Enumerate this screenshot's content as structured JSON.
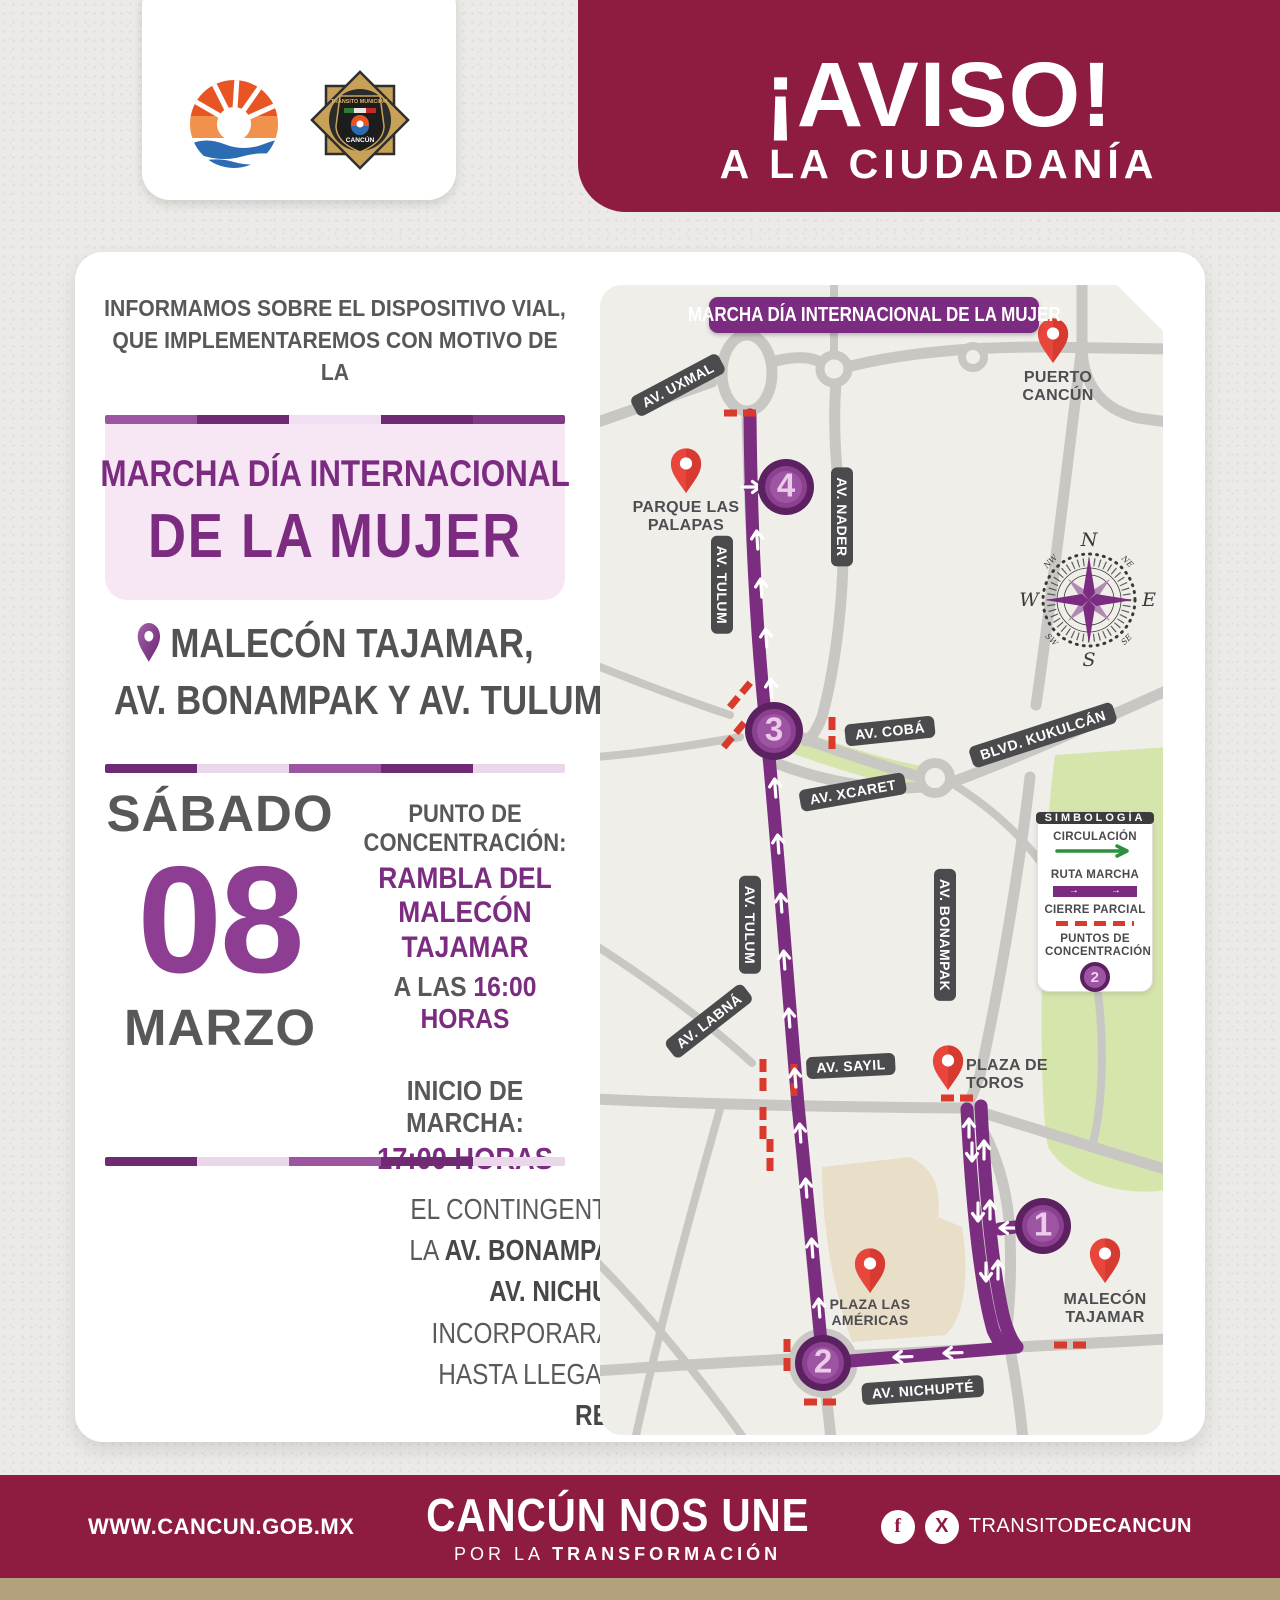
{
  "header": {
    "aviso_title": "¡AVISO!",
    "aviso_subtitle": "A LA CIUDADANÍA",
    "badge_line1": "TRÁNSITO MUNICIPAL",
    "badge_line2": "CANCÚN"
  },
  "intro": {
    "text": "INFORMAMOS SOBRE EL DISPOSITIVO VIAL, QUE IMPLEMENTAREMOS CON MOTIVO DE LA"
  },
  "event": {
    "title_line1": "MARCHA DÍA INTERNACIONAL",
    "title_line2": "DE LA MUJER"
  },
  "location": {
    "line1": "MALECÓN TAJAMAR,",
    "line2": "AV. BONAMPAK Y AV. TULUM"
  },
  "schedule": {
    "day": "SÁBADO",
    "date": "08",
    "month": "MARZO",
    "concentration_label": "PUNTO DE CONCENTRACIÓN:",
    "concentration_place": "RAMBLA DEL MALECÓN TAJAMAR",
    "concentration_time_prefix": "A LAS",
    "concentration_time": "16:00 HORAS",
    "march_label": "INICIO DE MARCHA:",
    "march_time": "17:00 HORAS"
  },
  "description": {
    "segments": [
      {
        "text": "EL CONTINGENTE SE DIRIGIRÁ SOBRE LA ",
        "bold": false
      },
      {
        "text": "AV. BONAMPAK",
        "bold": true
      },
      {
        "text": " EN DIRECCIÓN A LA ",
        "bold": false
      },
      {
        "text": "AV. NICHUPTÉ",
        "bold": true
      },
      {
        "text": " DONDE SE INCORPORARÁN EN LA ",
        "bold": false
      },
      {
        "text": "AV. TULUM,",
        "bold": true
      },
      {
        "text": " HASTA LLEGAR A LA ",
        "bold": false
      },
      {
        "text": "PLAZA DE LA REFORMA.",
        "bold": true
      }
    ]
  },
  "map": {
    "banner": "MARCHA DÍA INTERNACIONAL DE LA MUJER",
    "streets": {
      "uxmal": "AV. UXMAL",
      "nader": "AV. NADER",
      "tulum_upper": "AV. TULUM",
      "tulum_lower": "AV. TULUM",
      "coba": "AV. COBÁ",
      "kukulcan": "BLVD. KUKULCÁN",
      "xcaret": "AV. XCARET",
      "labna": "AV. LABNÁ",
      "sayil": "AV. SAYIL",
      "bonampak": "AV. BONAMPAK",
      "nichupte": "AV. NICHUPTÉ"
    },
    "places": {
      "puerto_cancun": "PUERTO CANCÚN",
      "parque_las_palapas": "PARQUE LAS PALAPAS",
      "plaza_de_toros": "PLAZA DE TOROS",
      "plaza_las_americas": "PLAZA LAS AMÉRICAS",
      "malecon_tajamar": "MALECÓN TAJAMAR"
    },
    "points": {
      "p1": "1",
      "p2": "2",
      "p3": "3",
      "p4": "4"
    },
    "compass": {
      "n": "N",
      "e": "E",
      "s": "S",
      "w": "W",
      "ne": "NE",
      "nw": "NW",
      "se": "SE",
      "sw": "SW"
    },
    "legend": {
      "title": "SIMBOLOGÍA",
      "items": [
        {
          "label": "CIRCULACIÓN"
        },
        {
          "label": "RUTA MARCHA"
        },
        {
          "label": "CIERRE PARCIAL"
        },
        {
          "label": "PUNTOS DE CONCENTRACIÓN"
        }
      ],
      "point_number": "2"
    }
  },
  "footer": {
    "website": "WWW.CANCUN.GOB.MX",
    "slogan_line1": "CANCÚN NOS UNE",
    "slogan_pre": "POR LA",
    "slogan_bold": "TRANSFORMACIÓN",
    "facebook_glyph": "f",
    "x_glyph": "X",
    "handle_regular": "TRANSITO",
    "handle_bold": "DECANCUN"
  },
  "colors": {
    "maroon": "#8e1c40",
    "purple": "#7b2c80",
    "purple_dark": "#5c2161",
    "purple_light": "#9d54a2",
    "pink_block": "#f7e6f4",
    "gray_text": "#58585b",
    "road_gray": "#c9c7c3",
    "map_bg": "#f0eee9",
    "green_area": "#d5e5ac",
    "closure_red": "#d93a2b",
    "pin_red": "#e8453b",
    "tan_strip": "#b3a07c",
    "circulation_green": "#2f8f3e"
  }
}
